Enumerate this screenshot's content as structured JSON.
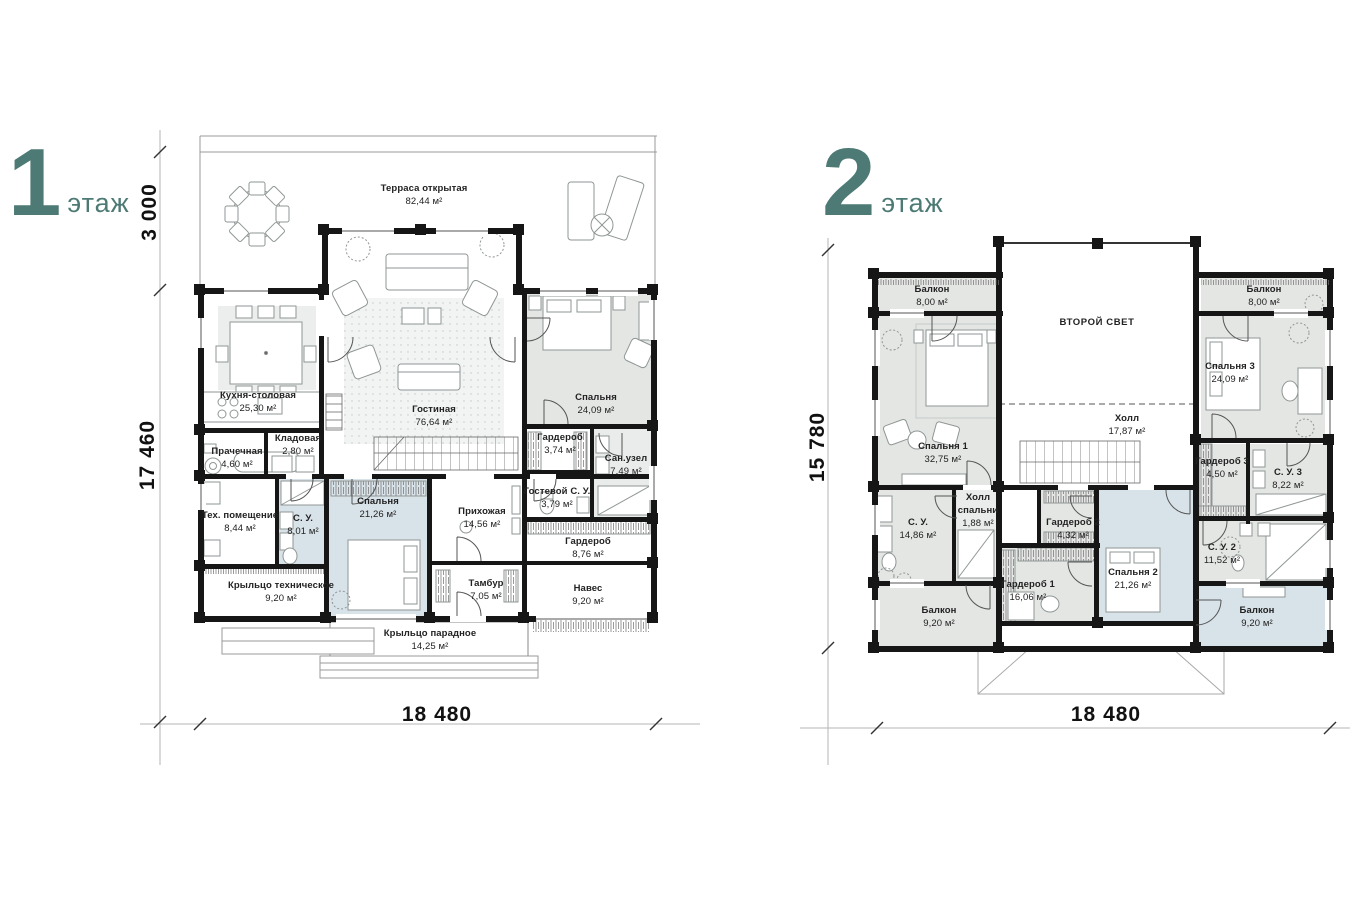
{
  "colors": {
    "accent_teal": "#4d7a74",
    "room_gray": "#e4e6e4",
    "room_blue": "#d8e2e9",
    "wall_black": "#161616"
  },
  "floor1": {
    "title_number": "1",
    "title_word": "этаж",
    "dims": {
      "terrace_depth": "3 000",
      "height": "17 460",
      "width": "18 480"
    },
    "rooms": [
      {
        "name": "Терраса открытая",
        "area": "82,44 м²"
      },
      {
        "name": "Кухня-столовая",
        "area": "25,30 м²"
      },
      {
        "name": "Гостиная",
        "area": "76,64 м²"
      },
      {
        "name": "Спальня",
        "area": "24,09 м²"
      },
      {
        "name": "Гардероб",
        "area": "3,74 м²"
      },
      {
        "name": "Сан.узел",
        "area": "7,49 м²"
      },
      {
        "name": "Гостевой С. У.",
        "area": "3,79 м²"
      },
      {
        "name": "Прачечная",
        "area": "4,60 м²"
      },
      {
        "name": "Кладовая",
        "area": "2,80 м²"
      },
      {
        "name": "Тех. помещение",
        "area": "8,44 м²"
      },
      {
        "name": "С. У.",
        "area": "8,01 м²"
      },
      {
        "name": "Спальня",
        "area": "21,26 м²"
      },
      {
        "name": "Прихожая",
        "area": "14,56 м²"
      },
      {
        "name": "Гардероб",
        "area": "8,76 м²"
      },
      {
        "name": "Крыльцо техническое",
        "area": "9,20 м²"
      },
      {
        "name": "Тамбур",
        "area": "7,05 м²"
      },
      {
        "name": "Навес",
        "area": "9,20 м²"
      },
      {
        "name": "Крыльцо парадное",
        "area": "14,25 м²"
      }
    ]
  },
  "floor2": {
    "title_number": "2",
    "title_word": "этаж",
    "dims": {
      "height": "15 780",
      "width": "18 480"
    },
    "rooms": [
      {
        "name": "Балкон",
        "area": "8,00 м²"
      },
      {
        "name": "ВТОРОЙ СВЕТ",
        "area": ""
      },
      {
        "name": "Балкон",
        "area": "8,00 м²"
      },
      {
        "name": "Спальня 1",
        "area": "32,75 м²"
      },
      {
        "name": "Холл",
        "area": "17,87 м²"
      },
      {
        "name": "Спальня 3",
        "area": "24,09 м²"
      },
      {
        "name": "Гардероб 3",
        "area": "4,50 м²"
      },
      {
        "name": "С. У. 3",
        "area": "8,22 м²"
      },
      {
        "name": "С. У.",
        "area": "14,86 м²"
      },
      {
        "name": "Холл спальни",
        "area": "1,88 м²"
      },
      {
        "name": "Гардероб 2",
        "area": "4,32 м²"
      },
      {
        "name": "С. У. 2",
        "area": "11,52 м²"
      },
      {
        "name": "Спальня 2",
        "area": "21,26 м²"
      },
      {
        "name": "Гардероб 1",
        "area": "16,06 м²"
      },
      {
        "name": "Балкон",
        "area": "9,20 м²"
      },
      {
        "name": "Балкон",
        "area": "9,20 м²"
      }
    ]
  }
}
